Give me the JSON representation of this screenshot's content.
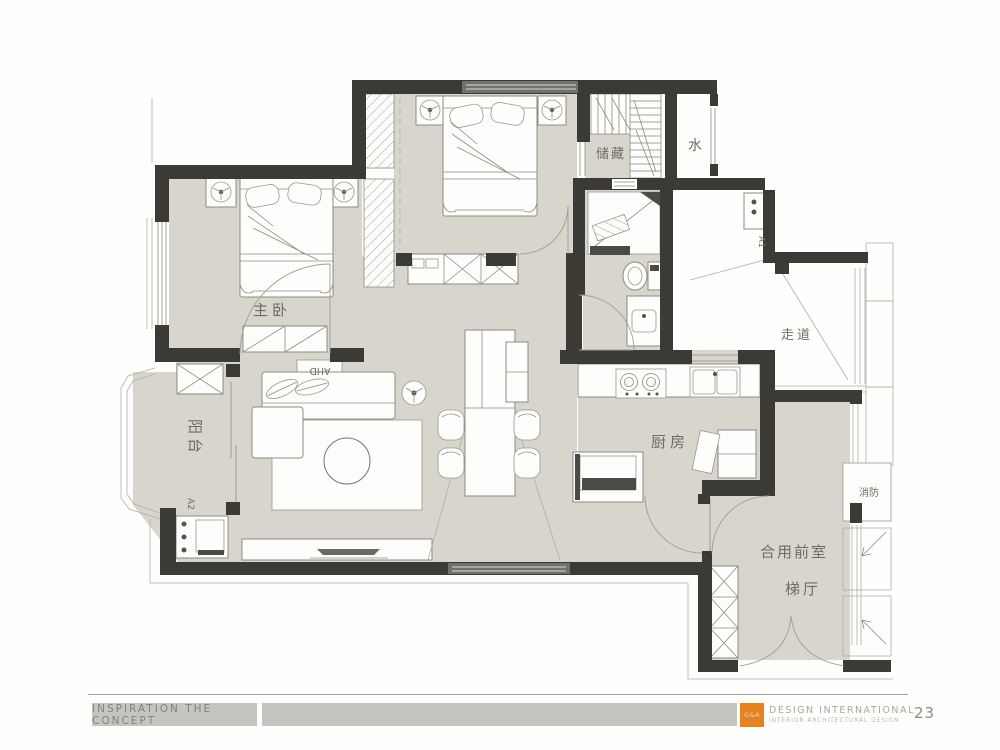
{
  "slide": {
    "footer": {
      "left_tab": "INSPIRATION THE CONCEPT",
      "brand_abbr": "G&A",
      "brand_name": "DESIGN INTERNATIONAL",
      "brand_tagline": "INTERIOR ARCHITECTURAL DESIGN",
      "page_number": "23"
    },
    "colors": {
      "accent_orange": "#E8821F",
      "wall_dark": "#3B3A37",
      "floor_beige": "#D8D5CC",
      "window_gray": "#71706D",
      "bar_gray": "#C5C4C0"
    }
  },
  "plan": {
    "room_labels": {
      "master_bedroom": "主卧",
      "balcony": "阳台",
      "kitchen": "厨房",
      "storage": "储藏",
      "water": "水",
      "corridor": "走道",
      "shared_front_room": "合用前室",
      "stair_hall": "梯厅",
      "fire_service": "消防"
    },
    "equipment_labels": {
      "ac_unit_1": "A1",
      "ac_unit_2": "A2",
      "air_handling_unit": "AHD"
    }
  }
}
